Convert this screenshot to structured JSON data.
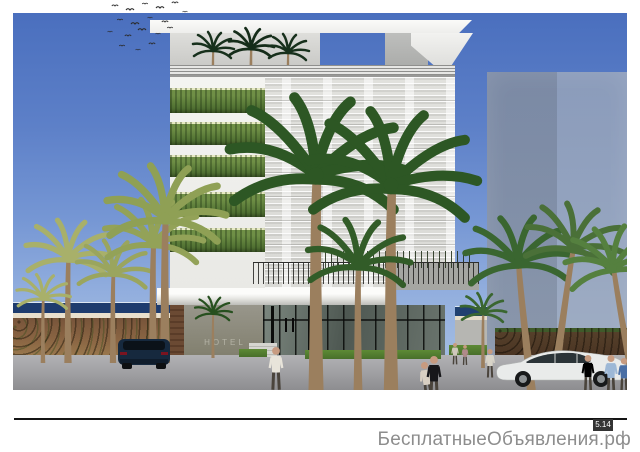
{
  "footer": {
    "watermark": "БесплатныеОбъявления.рф",
    "badge": "5.14"
  },
  "rendering": {
    "building_sign": "HOTEL",
    "colors": {
      "sky_top": "#4a6fbe",
      "sky_horizon": "#a9c2e4",
      "sea": "#1e3c6e",
      "beach_sand": "#e9e0cd",
      "beach_soil": "#8a6543",
      "road": "#a2a2a5",
      "facade_white": "#f4f4f1",
      "facade_louver": "#dcdcd8",
      "green_wall": "#567736",
      "glass": "#4e5852",
      "concrete": "#98968b",
      "ghost_building": "#9aa5b5",
      "grass": "#5d8a35",
      "palm_dark": "#2d5724",
      "palm_light": "#a8b06a",
      "suv": "#16293e",
      "sedan": "#e9ebea"
    }
  }
}
